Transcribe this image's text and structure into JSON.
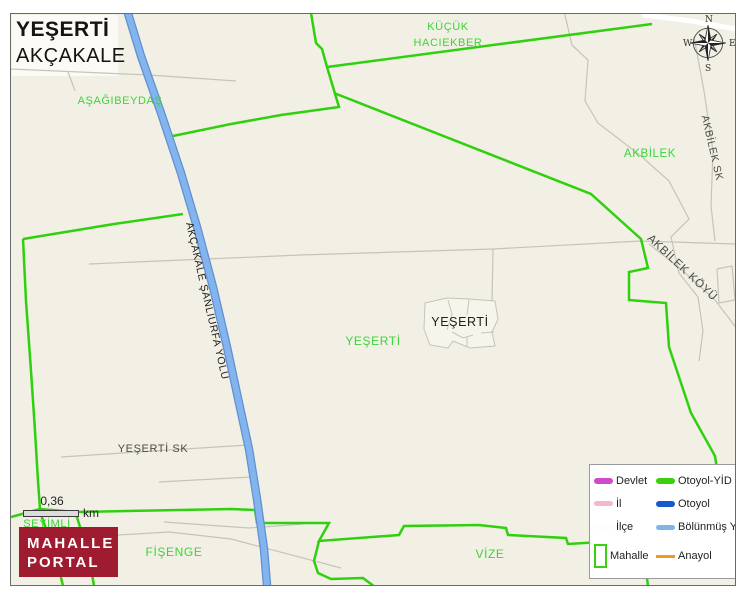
{
  "title": {
    "neighborhood": "YEŞERTİ",
    "district": "AKÇAKALE"
  },
  "compass": {
    "north": "N",
    "east": "E",
    "south": "S",
    "west": "W"
  },
  "scale_bar": {
    "value": "0,36",
    "unit": "km"
  },
  "logo": {
    "line1": "MAHALLE",
    "line2": "PORTAL",
    "bg_color": "#9e1b30"
  },
  "legend": {
    "items": [
      {
        "label": "Devlet",
        "swatch": "pill",
        "color": "#d04ad0",
        "thickness": 6
      },
      {
        "label": "Otoyol-YİD",
        "swatch": "pill",
        "color": "#3ad00f",
        "thickness": 6
      },
      {
        "label": "İl",
        "swatch": "pill",
        "color": "#f9b4d0",
        "thickness": 5
      },
      {
        "label": "Otoyol",
        "swatch": "pill",
        "color": "#1459cd",
        "thickness": 6
      },
      {
        "label": "İlçe",
        "swatch": "pill",
        "color": "#fdfdfd",
        "thickness": 5
      },
      {
        "label": "Bölünmüş Y",
        "swatch": "pill",
        "color": "#82b4e8",
        "thickness": 5
      },
      {
        "label": "Mahalle",
        "swatch": "rect",
        "color": "#3ad00f",
        "thickness": 2
      },
      {
        "label": "Anayol",
        "swatch": "line",
        "color": "#f0991e",
        "thickness": 3
      }
    ]
  },
  "map": {
    "background": "#f2f0e4",
    "colors": {
      "boundary_green": "#2fd00e",
      "label_green": "#3dd33d",
      "label_dark": "#4b4b45",
      "label_black": "#202020",
      "road_gray": "#c6c4ba",
      "road_blue_core": "#83b4ee",
      "road_blue_casing": "#5f90d3",
      "road_white": "#ffffff",
      "village_fill": "#f6f5ec"
    },
    "place_labels": [
      {
        "text": "AŞAĞIBEYDAŞ",
        "x": 119,
        "y": 100,
        "size": 11,
        "color": "green",
        "rot": 0
      },
      {
        "text": "KÜÇÜK",
        "x": 447,
        "y": 26,
        "size": 11,
        "color": "green",
        "rot": 0
      },
      {
        "text": "HACIEKBER",
        "x": 447,
        "y": 42,
        "size": 11,
        "color": "green",
        "rot": 0
      },
      {
        "text": "AKBİLEK",
        "x": 649,
        "y": 153,
        "size": 11.5,
        "color": "green",
        "rot": 0
      },
      {
        "text": "AKBİLEK SK",
        "x": 711,
        "y": 147,
        "size": 10.5,
        "color": "dark",
        "rot": 77
      },
      {
        "text": "AKBİLEK KÖYÜ",
        "x": 681,
        "y": 267,
        "size": 11.5,
        "color": "dark",
        "rot": 43
      },
      {
        "text": "YEŞERTİ",
        "x": 459,
        "y": 321,
        "size": 12.5,
        "color": "black",
        "rot": 0
      },
      {
        "text": "YEŞERTİ",
        "x": 372,
        "y": 340,
        "size": 12,
        "color": "green",
        "rot": 0
      },
      {
        "text": "AKÇAKALE ŞANLIURFA YOLU",
        "x": 206,
        "y": 300,
        "size": 10.5,
        "color": "black",
        "rot": 77
      },
      {
        "text": "YEŞERTİ SK",
        "x": 152,
        "y": 448,
        "size": 11,
        "color": "dark",
        "rot": 0
      },
      {
        "text": "ŞEYİMLİ",
        "x": 46,
        "y": 523,
        "size": 11,
        "color": "green",
        "rot": 0
      },
      {
        "text": "FİŞENGE",
        "x": 173,
        "y": 551,
        "size": 12,
        "color": "green",
        "rot": 0
      },
      {
        "text": "VİZE",
        "x": 489,
        "y": 553,
        "size": 12,
        "color": "green",
        "rot": 0
      }
    ],
    "gray_roads": [
      [
        [
          10,
          68
        ],
        [
          148,
          74
        ],
        [
          235,
          80
        ]
      ],
      [
        [
          67,
          71
        ],
        [
          74,
          90
        ]
      ],
      [
        [
          88,
          263
        ],
        [
          205,
          258
        ],
        [
          300,
          254
        ],
        [
          492,
          248
        ],
        [
          640,
          240
        ],
        [
          735,
          243
        ]
      ],
      [
        [
          492,
          248
        ],
        [
          491,
          302
        ]
      ],
      [
        [
          563,
          10
        ],
        [
          571,
          44
        ],
        [
          587,
          59
        ],
        [
          584,
          100
        ],
        [
          597,
          122
        ],
        [
          640,
          155
        ],
        [
          668,
          180
        ],
        [
          688,
          218
        ],
        [
          670,
          236
        ],
        [
          678,
          272
        ],
        [
          697,
          296
        ],
        [
          702,
          330
        ],
        [
          698,
          360
        ]
      ],
      [
        [
          693,
          36
        ],
        [
          703,
          90
        ],
        [
          712,
          150
        ],
        [
          710,
          205
        ],
        [
          714,
          240
        ]
      ],
      [
        [
          648,
          243
        ],
        [
          680,
          268
        ],
        [
          714,
          299
        ],
        [
          740,
          333
        ]
      ],
      [
        [
          716,
          268
        ],
        [
          731,
          265
        ],
        [
          734,
          299
        ],
        [
          718,
          302
        ],
        [
          716,
          268
        ]
      ],
      [
        [
          60,
          456
        ],
        [
          152,
          450
        ],
        [
          247,
          444
        ]
      ],
      [
        [
          158,
          481
        ],
        [
          250,
          476
        ]
      ],
      [
        [
          117,
          534
        ],
        [
          168,
          531
        ],
        [
          230,
          538
        ],
        [
          340,
          567
        ]
      ],
      [
        [
          163,
          521
        ],
        [
          248,
          527
        ],
        [
          302,
          523
        ]
      ]
    ],
    "green_boundaries": [
      [
        [
          308,
          0
        ],
        [
          315,
          42
        ],
        [
          321,
          48
        ],
        [
          326,
          66
        ],
        [
          338,
          106
        ],
        [
          280,
          114
        ],
        [
          230,
          123
        ],
        [
          167,
          136
        ]
      ],
      [
        [
          326,
          66
        ],
        [
          651,
          23
        ]
      ],
      [
        [
          333,
          92
        ],
        [
          590,
          193
        ],
        [
          640,
          238
        ],
        [
          647,
          267
        ],
        [
          628,
          271
        ],
        [
          628,
          299
        ],
        [
          665,
          302
        ],
        [
          668,
          346
        ],
        [
          690,
          412
        ],
        [
          714,
          455
        ],
        [
          716,
          468
        ]
      ],
      [
        [
          22,
          238
        ],
        [
          113,
          223
        ],
        [
          182,
          213
        ]
      ],
      [
        [
          22,
          238
        ],
        [
          25,
          300
        ],
        [
          30,
          370
        ],
        [
          34,
          430
        ],
        [
          37,
          480
        ],
        [
          39,
          508
        ]
      ],
      [
        [
          10,
          516
        ],
        [
          39,
          508
        ],
        [
          75,
          511
        ],
        [
          230,
          508
        ],
        [
          254,
          509
        ],
        [
          256,
          522
        ],
        [
          328,
          522
        ],
        [
          318,
          540
        ],
        [
          398,
          534
        ],
        [
          403,
          525
        ],
        [
          478,
          524
        ],
        [
          505,
          527
        ],
        [
          507,
          534
        ],
        [
          565,
          537
        ],
        [
          567,
          543
        ],
        [
          600,
          541
        ]
      ],
      [
        [
          318,
          540
        ],
        [
          313,
          560
        ],
        [
          317,
          572
        ],
        [
          330,
          578
        ],
        [
          362,
          577
        ],
        [
          374,
          586
        ],
        [
          420,
          588
        ]
      ],
      [
        [
          39,
          511
        ],
        [
          55,
          555
        ],
        [
          62,
          585
        ]
      ],
      [
        [
          75,
          513
        ],
        [
          88,
          555
        ],
        [
          93,
          585
        ]
      ],
      [
        [
          645,
          570
        ],
        [
          647,
          585
        ]
      ]
    ],
    "white_roads": [
      [
        [
          643,
          14
        ],
        [
          690,
          20
        ],
        [
          735,
          28
        ]
      ]
    ],
    "blue_road": [
      [
        122,
        -4
      ],
      [
        140,
        55
      ],
      [
        160,
        112
      ],
      [
        180,
        172
      ],
      [
        196,
        226
      ],
      [
        212,
        286
      ],
      [
        226,
        346
      ],
      [
        238,
        402
      ],
      [
        248,
        448
      ],
      [
        256,
        498
      ],
      [
        263,
        548
      ],
      [
        266,
        584
      ],
      [
        268,
        602
      ]
    ],
    "village_cluster": {
      "outline": "M424,302 L446,297 L468,298 L494,300 L497,318 L491,331 L494,345 L469,347 L452,340 L447,347 L429,344 L423,328 Z",
      "inner_lines": [
        [
          [
            447,
            299
          ],
          [
            451,
            313
          ],
          [
            446,
            329
          ]
        ],
        [
          [
            468,
            299
          ],
          [
            466,
            314
          ]
        ],
        [
          [
            451,
            331
          ],
          [
            462,
            337
          ],
          [
            472,
            334
          ]
        ],
        [
          [
            466,
            336
          ],
          [
            466,
            346
          ]
        ],
        [
          [
            480,
            332
          ],
          [
            493,
            331
          ]
        ]
      ]
    }
  }
}
